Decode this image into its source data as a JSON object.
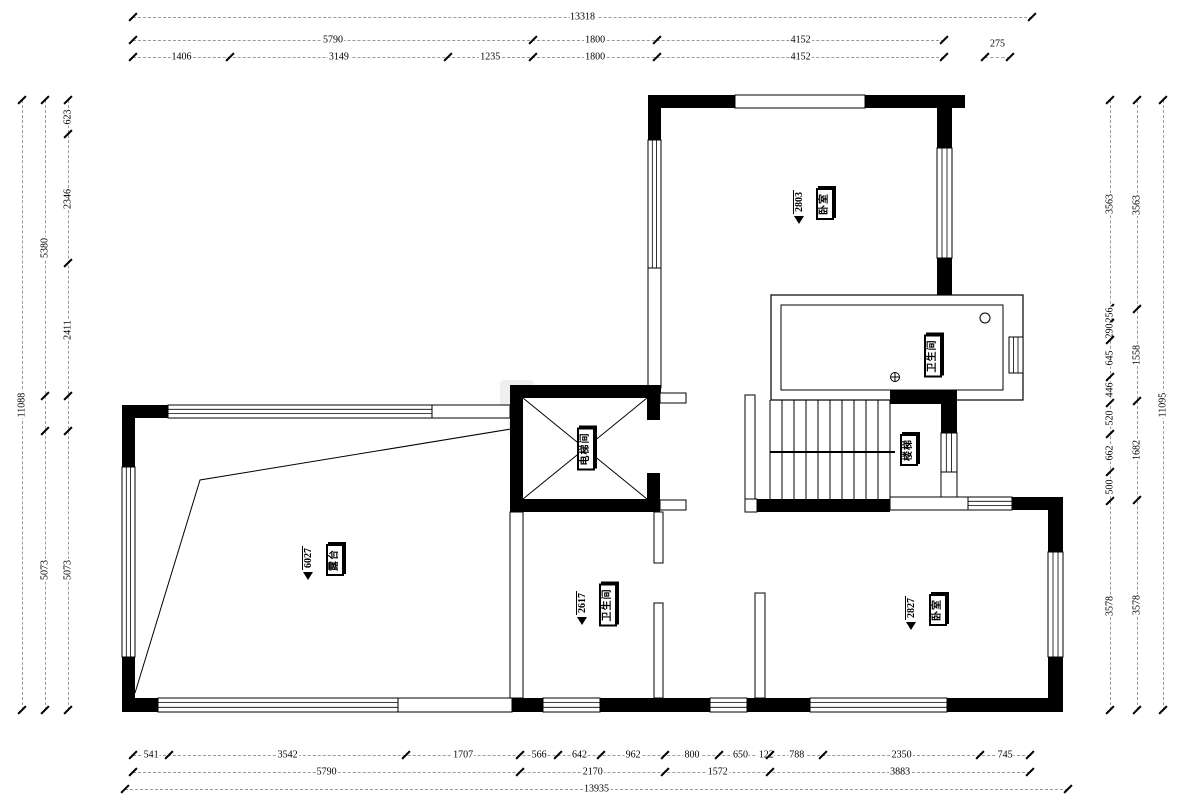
{
  "title": "户型平面图",
  "colors": {
    "wall": "#000000",
    "dim_line": "#9a9a9a",
    "background": "#ffffff",
    "text": "#000000"
  },
  "rooms": [
    {
      "id": "bedroom-top",
      "label": "卧室",
      "level": "2803"
    },
    {
      "id": "bathroom-top",
      "label": "卫生间",
      "level": ""
    },
    {
      "id": "elevator",
      "label": "电梯间",
      "level": ""
    },
    {
      "id": "stairs",
      "label": "楼梯",
      "level": ""
    },
    {
      "id": "terrace",
      "label": "露台",
      "level": "6027"
    },
    {
      "id": "bathroom-bottom",
      "label": "卫生间",
      "level": "2617"
    },
    {
      "id": "bedroom-bottom",
      "label": "卧室",
      "level": "2827"
    }
  ],
  "dimensions": {
    "chains": [
      {
        "name": "dim-top-overall",
        "dir": "h",
        "pos": 17,
        "from": 133,
        "to": 1032,
        "segments": [
          {
            "label": "13318",
            "value": 13318
          }
        ]
      },
      {
        "name": "dim-top-mid",
        "dir": "h",
        "pos": 40,
        "from": 133,
        "to": 944,
        "segments": [
          {
            "label": "5790",
            "value": 5790
          },
          {
            "label": "1800",
            "value": 1800
          },
          {
            "label": "4152",
            "value": 4152
          }
        ]
      },
      {
        "name": "dim-top-detail",
        "dir": "h",
        "pos": 57,
        "from": 133,
        "to": 944,
        "segments": [
          {
            "label": "1406",
            "value": 1406
          },
          {
            "label": "3149",
            "value": 3149
          },
          {
            "label": "1235",
            "value": 1235
          },
          {
            "label": "1800",
            "value": 1800
          },
          {
            "label": "4152",
            "value": 4152
          }
        ]
      },
      {
        "name": "dim-top-right",
        "dir": "h",
        "pos": 57,
        "from": 985,
        "to": 1010,
        "labelDy": -13,
        "segments": [
          {
            "label": "275",
            "value": 275
          }
        ]
      },
      {
        "name": "dim-bottom-detail",
        "dir": "h",
        "pos": 755,
        "from": 133,
        "to": 1030,
        "segments": [
          {
            "label": "541",
            "value": 541
          },
          {
            "label": "3542",
            "value": 3542
          },
          {
            "label": "1707",
            "value": 1707
          },
          {
            "label": "566",
            "value": 566
          },
          {
            "label": "642",
            "value": 642
          },
          {
            "label": "962",
            "value": 962
          },
          {
            "label": "800",
            "value": 800
          },
          {
            "label": "650",
            "value": 650
          },
          {
            "label": "122",
            "value": 122
          },
          {
            "label": "788",
            "value": 788
          },
          {
            "label": "2350",
            "value": 2350
          },
          {
            "label": "745",
            "value": 745
          }
        ]
      },
      {
        "name": "dim-bottom-mid",
        "dir": "h",
        "pos": 772,
        "from": 133,
        "to": 1030,
        "segments": [
          {
            "label": "5790",
            "value": 5790
          },
          {
            "label": "2170",
            "value": 2170
          },
          {
            "label": "1572",
            "value": 1572
          },
          {
            "label": "3883",
            "value": 3883
          }
        ]
      },
      {
        "name": "dim-bottom-overall",
        "dir": "h",
        "pos": 789,
        "from": 125,
        "to": 1068,
        "segments": [
          {
            "label": "13935",
            "value": 13935
          }
        ]
      },
      {
        "name": "dim-left-outer",
        "dir": "v",
        "pos": 22,
        "from": 100,
        "to": 710,
        "segments": [
          {
            "label": "11088",
            "value": 11088
          }
        ]
      },
      {
        "name": "dim-left-mid",
        "dir": "v",
        "pos": 45,
        "from": 100,
        "to": 710,
        "segments": [
          {
            "label": "5380",
            "value": 5380
          },
          {
            "label": "",
            "value": 635
          },
          {
            "label": "5073",
            "value": 5073
          }
        ]
      },
      {
        "name": "dim-left-inner",
        "dir": "v",
        "pos": 68,
        "from": 100,
        "to": 710,
        "segments": [
          {
            "label": "623",
            "value": 623
          },
          {
            "label": "2346",
            "value": 2346
          },
          {
            "label": "2411",
            "value": 2411
          },
          {
            "label": "",
            "value": 635
          },
          {
            "label": "5073",
            "value": 5073
          }
        ]
      },
      {
        "name": "dim-right-inner",
        "dir": "v",
        "pos": 1110,
        "from": 100,
        "to": 710,
        "segments": [
          {
            "label": "3563",
            "value": 3563
          },
          {
            "label": "256",
            "value": 256
          },
          {
            "label": "290",
            "value": 290
          },
          {
            "label": "645",
            "value": 645
          },
          {
            "label": "446",
            "value": 446
          },
          {
            "label": "520",
            "value": 520
          },
          {
            "label": "662",
            "value": 662
          },
          {
            "label": "500",
            "value": 500
          },
          {
            "label": "3578",
            "value": 3578
          }
        ]
      },
      {
        "name": "dim-right-mid",
        "dir": "v",
        "pos": 1137,
        "from": 100,
        "to": 710,
        "segments": [
          {
            "label": "3563",
            "value": 3563
          },
          {
            "label": "1558",
            "value": 1558
          },
          {
            "label": "1682",
            "value": 1682
          },
          {
            "label": "3578",
            "value": 3578
          }
        ]
      },
      {
        "name": "dim-right-outer",
        "dir": "v",
        "pos": 1163,
        "from": 100,
        "to": 710,
        "segments": [
          {
            "label": "11095",
            "value": 11095
          }
        ]
      }
    ]
  }
}
